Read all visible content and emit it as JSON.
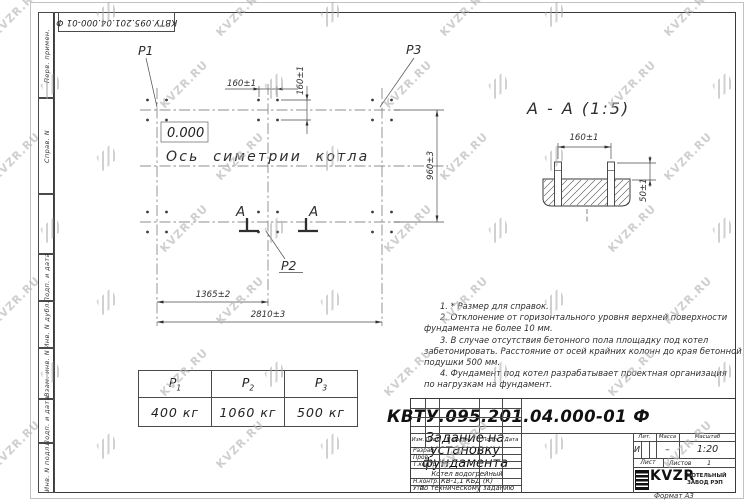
{
  "watermark": {
    "text": "KVZR.RU"
  },
  "corner_stamp": {
    "doc_number": "КВТУ.095.201.04.000-01 Ф"
  },
  "margin_labels": {
    "perv_primen": "Перв. примен.",
    "sprav_n": "Справ. N",
    "podp_i_data_1": "Подп. и дата",
    "inv_n_dubl": "Инв. N дубл.",
    "vzam_inv_n": "Взам. инв. N",
    "podp_i_data_2": "Подп. и дата",
    "inv_n_podl": "Инв. N подл."
  },
  "plan": {
    "p1": "P1",
    "p2": "P2",
    "p3": "P3",
    "elevation": "0.000",
    "axis_label": "Ось симетрии котла",
    "section_letter_left": "A",
    "section_letter_right": "A",
    "dim_160_h": "160±1",
    "dim_160_v": "160±1",
    "dim_960": "960±3",
    "dim_1365": "1365±2",
    "dim_2810": "2810±3"
  },
  "section_view": {
    "title": "A - A (1:5)",
    "dim_160": "160±1",
    "dim_50": "50±1"
  },
  "notes": {
    "lines": [
      "      1. * Размер для справок.",
      "      2. Отклонение от горизонтального уровня верхней поверхности",
      "фундамента не более 10 мм.",
      "      3. В случае отсутствия бетонного пола площадку под котел",
      "забетонировать. Расстояние от осей крайних колонн до края бетонной",
      "подушки 500 мм.",
      "      4. Фундамент под котел разрабатывает проектная организация",
      "по нагрузкам на фундамент."
    ]
  },
  "load_table": {
    "headers": [
      {
        "sym": "P",
        "sub": "1"
      },
      {
        "sym": "P",
        "sub": "2"
      },
      {
        "sym": "P",
        "sub": "3"
      }
    ],
    "values": [
      "400 кг",
      "1060 кг",
      "500 кг"
    ]
  },
  "title_block": {
    "doc_number": "КВТУ.095.201.04.000-01 Ф",
    "title": "Задание на установку фундамента",
    "product": [
      "Котел водогрейный",
      "КВ-1,1 КБД (К)",
      "по техническому заданию"
    ],
    "col_izm": "Изм.",
    "col_list": "Лист",
    "col_n_dokum": "N докум.",
    "col_podp": "Подп.",
    "col_data": "Дата",
    "row_razrab": "Разраб.",
    "row_prov": "Пров.",
    "row_tkontr": "Т.контр.",
    "row_nkontr": "Н.контр.",
    "row_utv": "Утв.",
    "lit_label": "Лит.",
    "massa_label": "Масса",
    "masshtab_label": "Масштаб",
    "lit_value": "И",
    "massa_value": "–",
    "masshtab_value": "1:20",
    "list_label": "Лист",
    "listov_label": "Листов",
    "listov_value": "1",
    "logo_text": "KVZR",
    "logo_caption": [
      "КОТЕЛЬНЫЙ",
      "ЗАВОД РЭП"
    ],
    "format_label": "Формат А3"
  }
}
